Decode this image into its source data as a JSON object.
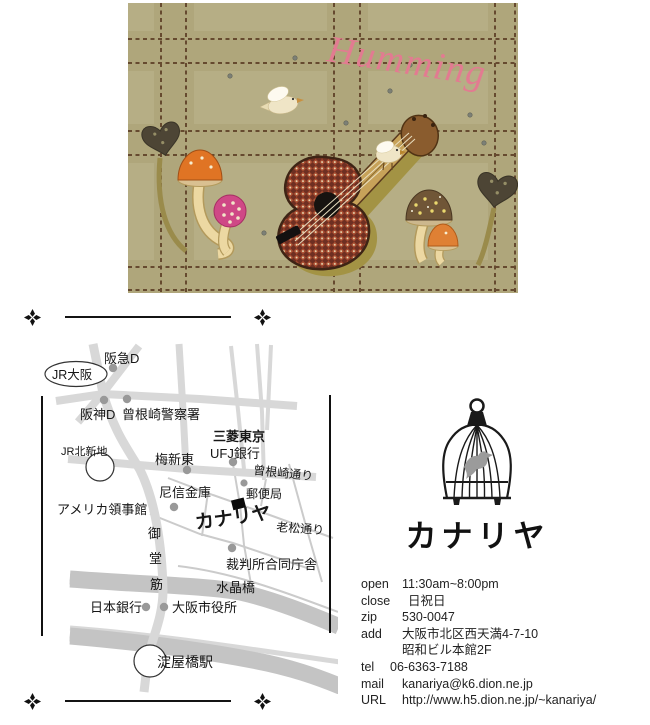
{
  "art": {
    "title": "Humming",
    "desc": "applique fabric artwork: plaid wool, mushrooms, heart leaves, two birds, checkered guitar",
    "colors": {
      "fabric": "#b6ae85",
      "title_pink": "#e27b91",
      "guitar_red": "#a64a2e",
      "backing_olive": "#a39344"
    }
  },
  "map": {
    "hankyu": "阪急D",
    "jr_osaka": "JR大阪",
    "hanshin": "阪神D",
    "police": "曾根崎警察署",
    "mitsubishi_line1": "三菱東京",
    "mitsubishi_line2": "UFJ銀行",
    "jr_kitashinchi": "JR北新地",
    "umeshin": "梅新東",
    "sonezaki_dori": "曾根崎通り",
    "amashin": "尼信金庫",
    "post_office": "郵便局",
    "us_consulate": "アメリカ領事館",
    "kanariya": "カナリヤ",
    "oimatsu_dori": "老松通り",
    "mido_1": "御",
    "mido_2": "堂",
    "mido_3": "筋",
    "court": "裁判所合同庁舎",
    "suisho_bridge": "水晶橋",
    "bank_of_japan": "日本銀行",
    "city_hall": "大阪市役所",
    "yodoyabashi": "淀屋橋駅",
    "colors": {
      "road": "#d8d8d8",
      "street": "#cbcbcb",
      "river": "#c4c4c4",
      "river_stripe": "#a6a6a6",
      "dot": "#999999"
    }
  },
  "logo": {
    "name": "カナリヤ"
  },
  "info": {
    "rows": [
      {
        "label": "open",
        "value": "11:30am~8:00pm"
      },
      {
        "label": "close",
        "value": "日祝日"
      },
      {
        "label": "zip",
        "value": "530-0047"
      },
      {
        "label": "add",
        "value": "大阪市北区西天満4-7-10",
        "value2": "昭和ビル本館2F"
      },
      {
        "label": "tel",
        "value": "06-6363-7188"
      },
      {
        "label": "mail",
        "value": "kanariya@k6.dion.ne.jp"
      },
      {
        "label": "URL",
        "value": "http://www.h5.dion.ne.jp/~kanariya/"
      }
    ]
  }
}
